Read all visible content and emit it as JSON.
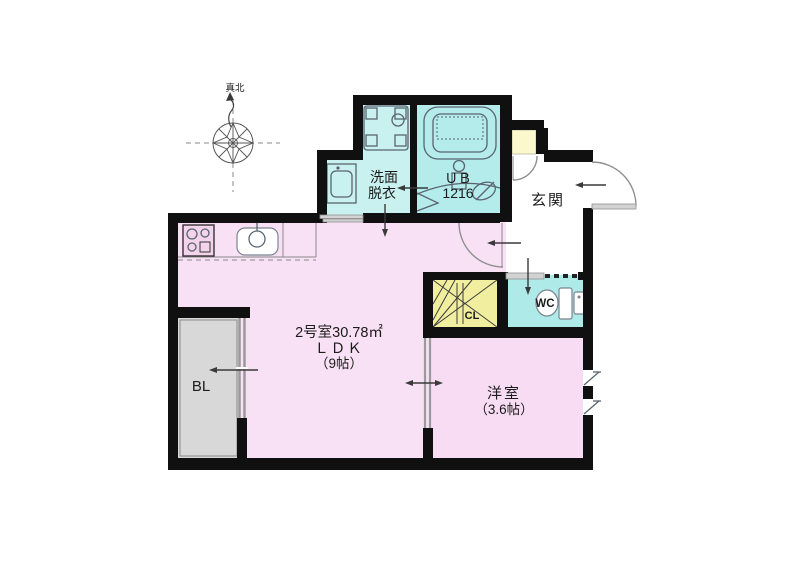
{
  "compass": {
    "label": "真北"
  },
  "rooms": {
    "washroom": {
      "line1": "洗面",
      "line2": "脱衣"
    },
    "unit_bath": {
      "line1": "ＵＢ",
      "line2": "1216"
    },
    "entrance": {
      "label": "玄関"
    },
    "ldk": {
      "line1": "2号室30.78㎡",
      "line2": "ＬＤＫ",
      "line3": "（9帖）"
    },
    "western_room": {
      "line1": "洋室",
      "line2": "（3.6帖）"
    },
    "balcony": {
      "label": "BL"
    },
    "toilet": {
      "label": "WC"
    },
    "closet": {
      "label": "CL"
    }
  },
  "colors": {
    "wall": "#101010",
    "room_pink": "#f8e1f5",
    "western_pink": "#f8dcf3",
    "bath_cyan": "#b4ebeb",
    "washroom_cyan": "#c9f1ef",
    "wc_cyan": "#aeeae7",
    "closet_yellow": "#f1ee9f",
    "shoebox_yellow": "#fbf8cd",
    "balcony_gray": "#d8d8d8"
  }
}
